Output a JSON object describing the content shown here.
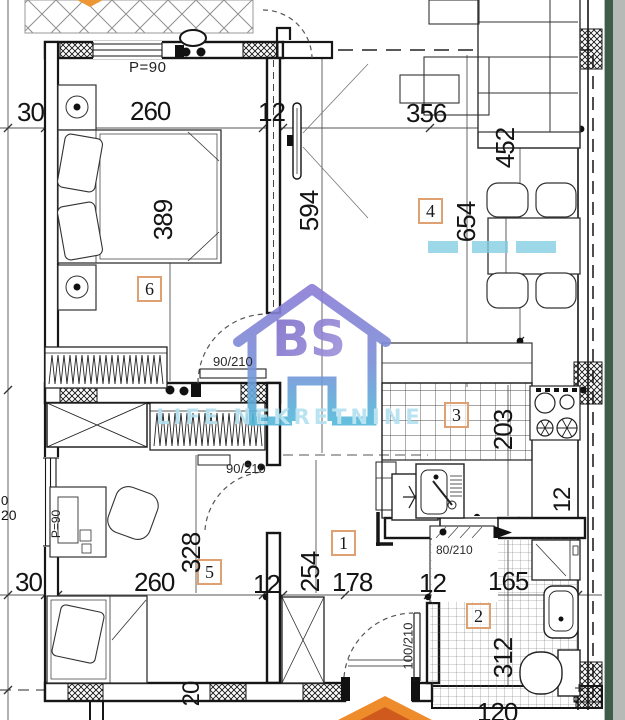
{
  "watermark": {
    "initials": "BS",
    "company": "LIFE NEKRETNINE"
  },
  "room_labels": {
    "hall": "1",
    "bathroom": "2",
    "kitchen": "3",
    "living": "4",
    "bedroom_second": "5",
    "bedroom_main": "6"
  },
  "dimensions": {
    "top_30": "30",
    "top_260": "260",
    "top_12": "12",
    "living_356": "356",
    "living_452": "452",
    "living_654": "654",
    "living_594": "594",
    "bedroom_389": "389",
    "kitchen_203": "203",
    "kitchen_12": "12",
    "bedroom2_328": "328",
    "hall_254": "254",
    "bottom_30": "30",
    "bottom_260": "260",
    "bottom_12_left": "12",
    "hall_178": "178",
    "bottom_12_right": "12",
    "bath_165": "165",
    "bath_312": "312",
    "bath_120": "120",
    "wall_20": "20",
    "edge_frag_0": "0",
    "edge_frag_20": "20"
  },
  "openings": {
    "window_top": "P=90",
    "window_left": "P=90",
    "door_bedroom_main": "90/210",
    "door_bedroom_second": "90/210",
    "door_bathroom": "80/210",
    "door_entrance": "100/210"
  },
  "colors": {
    "accent_room_box": "#dfa072",
    "marker_orange": "#ec8c2c",
    "marker_orange_dark": "#d05a1d",
    "watermark_purple": "#8a7cd4",
    "watermark_cyan": "#5ab8da",
    "watermark_text": "#b2e1f0",
    "scan_strip": "#b6bab6",
    "scan_line": "#3f5c4a"
  }
}
